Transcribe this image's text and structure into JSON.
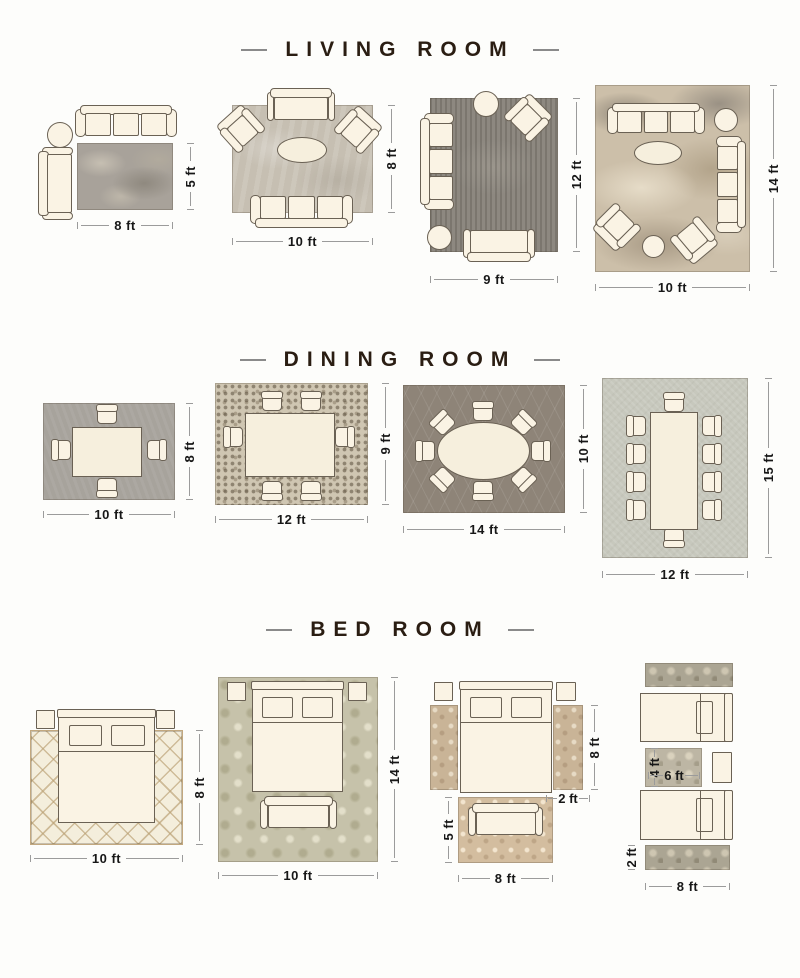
{
  "page": {
    "background": "#fdfdfb"
  },
  "colors": {
    "title_text": "#2a1d12",
    "title_rule": "#8a8a8a",
    "dimension_text": "#171717",
    "dimension_line": "#9b9b9b",
    "furniture_fill": "#faf3e4",
    "furniture_outline": "#6a6154"
  },
  "sections": [
    {
      "id": "living-room",
      "title": "LIVING ROOM",
      "layouts": [
        {
          "width_label": "8 ft",
          "height_label": "5 ft",
          "rug_color": "#a8a29a"
        },
        {
          "width_label": "10 ft",
          "height_label": "8 ft",
          "rug_color": "#c6bfb2"
        },
        {
          "width_label": "9 ft",
          "height_label": "12 ft",
          "rug_color": "#8d8880"
        },
        {
          "width_label": "10 ft",
          "height_label": "14 ft",
          "rug_color": "#ccbfa9"
        }
      ]
    },
    {
      "id": "dining-room",
      "title": "DINING ROOM",
      "layouts": [
        {
          "width_label": "10 ft",
          "height_label": "8 ft",
          "rug_color": "#a7a39c"
        },
        {
          "width_label": "12 ft",
          "height_label": "9 ft",
          "rug_color": "#cfc6b2"
        },
        {
          "width_label": "14 ft",
          "height_label": "10 ft",
          "rug_color": "#8e8478"
        },
        {
          "width_label": "12 ft",
          "height_label": "15 ft",
          "rug_color": "#c7c8bd"
        }
      ]
    },
    {
      "id": "bed-room",
      "title": "BED ROOM",
      "layouts": [
        {
          "width_label": "10 ft",
          "height_label": "8 ft",
          "rug_color": "#f4eedc"
        },
        {
          "width_label": "10 ft",
          "height_label": "14 ft",
          "rug_color": "#c6c2aa"
        },
        {
          "side_runner_length_label": "8 ft",
          "side_runner_width_label": "2 ft",
          "foot_rug_height_label": "5 ft",
          "foot_rug_width_label": "8 ft",
          "rug_color": "#c9b497"
        },
        {
          "middle_rug_height_label": "4 ft",
          "middle_rug_width_label": "6 ft",
          "runner_width_label": "2 ft",
          "runner_length_label": "8 ft",
          "rug_color": "#aba593"
        }
      ]
    }
  ]
}
